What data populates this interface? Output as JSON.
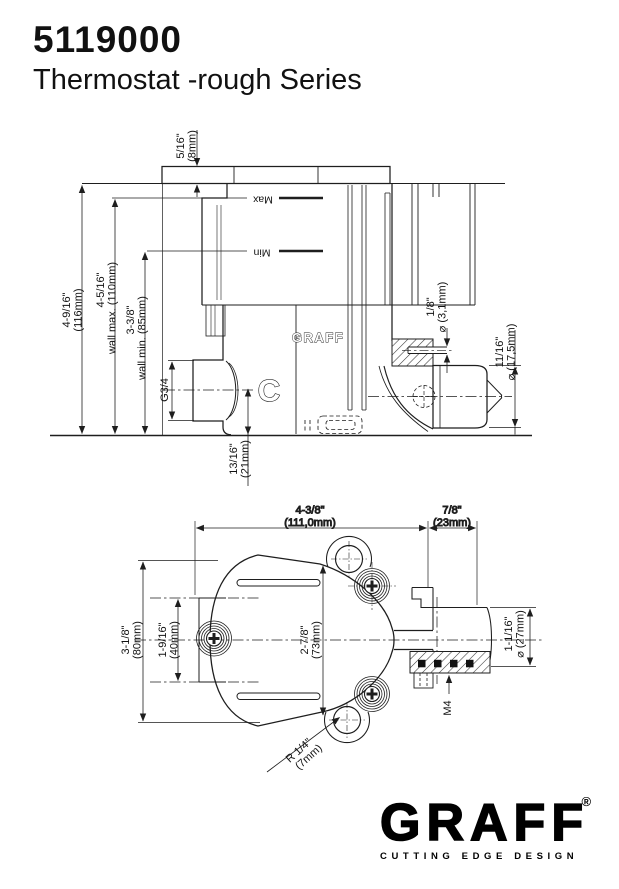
{
  "page": {
    "model_number": "5119000",
    "series_title": "Thermostat -rough Series"
  },
  "top_drawing": {
    "labels": {
      "max": "Max",
      "min": "Min",
      "brand_emboss": "GRAFF",
      "cold_indicator": "C",
      "inlet_thread": "G3/4"
    },
    "dimensions": {
      "cap_depth_in": "5/16\"",
      "cap_depth_mm": "(8mm)",
      "overall_height_in": "4-9/16\"",
      "overall_height_mm": "(116mm)",
      "wall_max_in": "4-5/16\"",
      "wall_max_note": "wall max. (110mm)",
      "wall_min_in": "3-3/8\"",
      "wall_min_note": "wall min. (85mm)",
      "outlet_drop_in": "13/16\"",
      "outlet_drop_mm": "(21mm)",
      "hole_in": "1/8\"",
      "hole_mm": "⌀ (3,1mm)",
      "cartridge_in": "11/16\"",
      "cartridge_mm": "⌀ (17,5mm)"
    }
  },
  "bottom_drawing": {
    "dimensions": {
      "width_in": "4-3/8\"",
      "width_mm": "(111,0mm)",
      "extension_in": "7/8\"",
      "extension_mm": "(23mm)",
      "height_in": "3-1/8\"",
      "height_mm": "(80mm)",
      "spacing_in": "1-9/16\"",
      "spacing_mm": "(40mm)",
      "depth_in": "2-7/8\"",
      "depth_mm": "(73mm)",
      "outlet_in": "1-1/16\"",
      "outlet_mm": "⌀ (27mm)",
      "screw_thread": "M4",
      "radius_in": "R 1/4\"",
      "radius_mm": "(7mm)"
    }
  },
  "footer": {
    "brand": "GRAFF",
    "registered_mark": "®",
    "tagline": "CUTTING EDGE DESIGN"
  }
}
